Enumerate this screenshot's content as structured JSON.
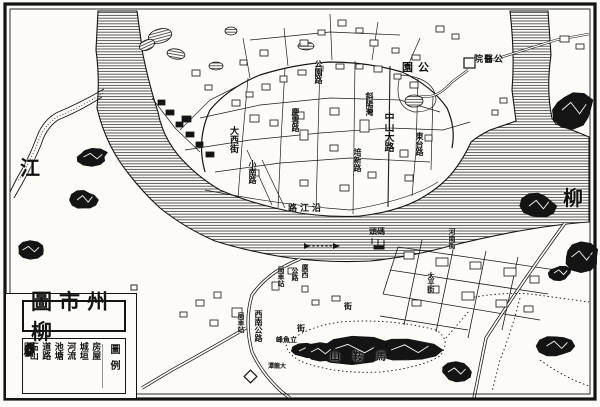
{
  "map_title": {
    "text": "柳州市圖",
    "display": "圖市州柳"
  },
  "legend": {
    "heading": "圖例",
    "items": [
      {
        "label": "石山",
        "symbol": "rock-hill"
      },
      {
        "label": "道路",
        "symbol": "road"
      },
      {
        "label": "池塘",
        "symbol": "pond"
      },
      {
        "label": "河流",
        "symbol": "river"
      },
      {
        "label": "城垣",
        "symbol": "city-wall"
      },
      {
        "label": "房屋",
        "symbol": "houses"
      }
    ]
  },
  "river": {
    "name": "柳江",
    "label_west": "江",
    "label_east": "柳"
  },
  "labels": [
    {
      "text": "江",
      "x": 20,
      "y": 158,
      "size": 20,
      "orient": "h"
    },
    {
      "text": "柳",
      "x": 563,
      "y": 188,
      "size": 20,
      "orient": "h"
    },
    {
      "text": "公園",
      "x": 402,
      "y": 62,
      "size": 11,
      "orient": "h",
      "rtl": true,
      "ls": 5
    },
    {
      "text": "公醫院",
      "x": 474,
      "y": 54,
      "size": 9,
      "orient": "h",
      "rtl": true,
      "ls": 1
    },
    {
      "text": "公園路",
      "x": 314,
      "y": 60,
      "size": 8,
      "orient": "v"
    },
    {
      "text": "斜陽灣",
      "x": 365,
      "y": 92,
      "size": 8,
      "orient": "v"
    },
    {
      "text": "慶雲路",
      "x": 291,
      "y": 108,
      "size": 8,
      "orient": "v"
    },
    {
      "text": "大西街",
      "x": 229,
      "y": 126,
      "size": 9,
      "orient": "v"
    },
    {
      "text": "中山大路",
      "x": 382,
      "y": 112,
      "size": 10,
      "orient": "v"
    },
    {
      "text": "東台路",
      "x": 415,
      "y": 132,
      "size": 8,
      "orient": "v"
    },
    {
      "text": "培新路",
      "x": 353,
      "y": 148,
      "size": 8,
      "orient": "v"
    },
    {
      "text": "小南路",
      "x": 248,
      "y": 160,
      "size": 8,
      "orient": "v"
    },
    {
      "text": "沿江路",
      "x": 288,
      "y": 203,
      "size": 9,
      "orient": "h",
      "rtl": true,
      "ls": 3
    },
    {
      "text": "碼頭",
      "x": 369,
      "y": 227,
      "size": 8,
      "orient": "h",
      "rtl": true
    },
    {
      "text": "廣西",
      "x": 301,
      "y": 264,
      "size": 7,
      "orient": "v"
    },
    {
      "text": "公路",
      "x": 291,
      "y": 267,
      "size": 7,
      "orient": "v"
    },
    {
      "text": "局車站",
      "x": 277,
      "y": 266,
      "size": 7,
      "orient": "v"
    },
    {
      "text": "西南公路",
      "x": 254,
      "y": 310,
      "size": 8,
      "orient": "v"
    },
    {
      "text": "局車站",
      "x": 237,
      "y": 312,
      "size": 7,
      "orient": "v"
    },
    {
      "text": "河南街",
      "x": 448,
      "y": 228,
      "size": 7,
      "orient": "v"
    },
    {
      "text": "太平街",
      "x": 427,
      "y": 272,
      "size": 7,
      "orient": "v"
    },
    {
      "text": "街",
      "x": 344,
      "y": 302,
      "size": 8,
      "orient": "h"
    },
    {
      "text": "街",
      "x": 297,
      "y": 324,
      "size": 8,
      "orient": "h"
    },
    {
      "text": "立魚峰",
      "x": 276,
      "y": 336,
      "size": 7,
      "orient": "h",
      "rtl": true
    },
    {
      "text": "大龍潭",
      "x": 268,
      "y": 364,
      "size": 6,
      "orient": "h",
      "rtl": true
    },
    {
      "text": "馬鞍山",
      "x": 330,
      "y": 352,
      "size": 10,
      "orient": "h",
      "rtl": true,
      "ls": 13
    }
  ],
  "colors": {
    "paper": "#fcfbf7",
    "ink": "#141414",
    "hatch": "#2a2a2a"
  }
}
